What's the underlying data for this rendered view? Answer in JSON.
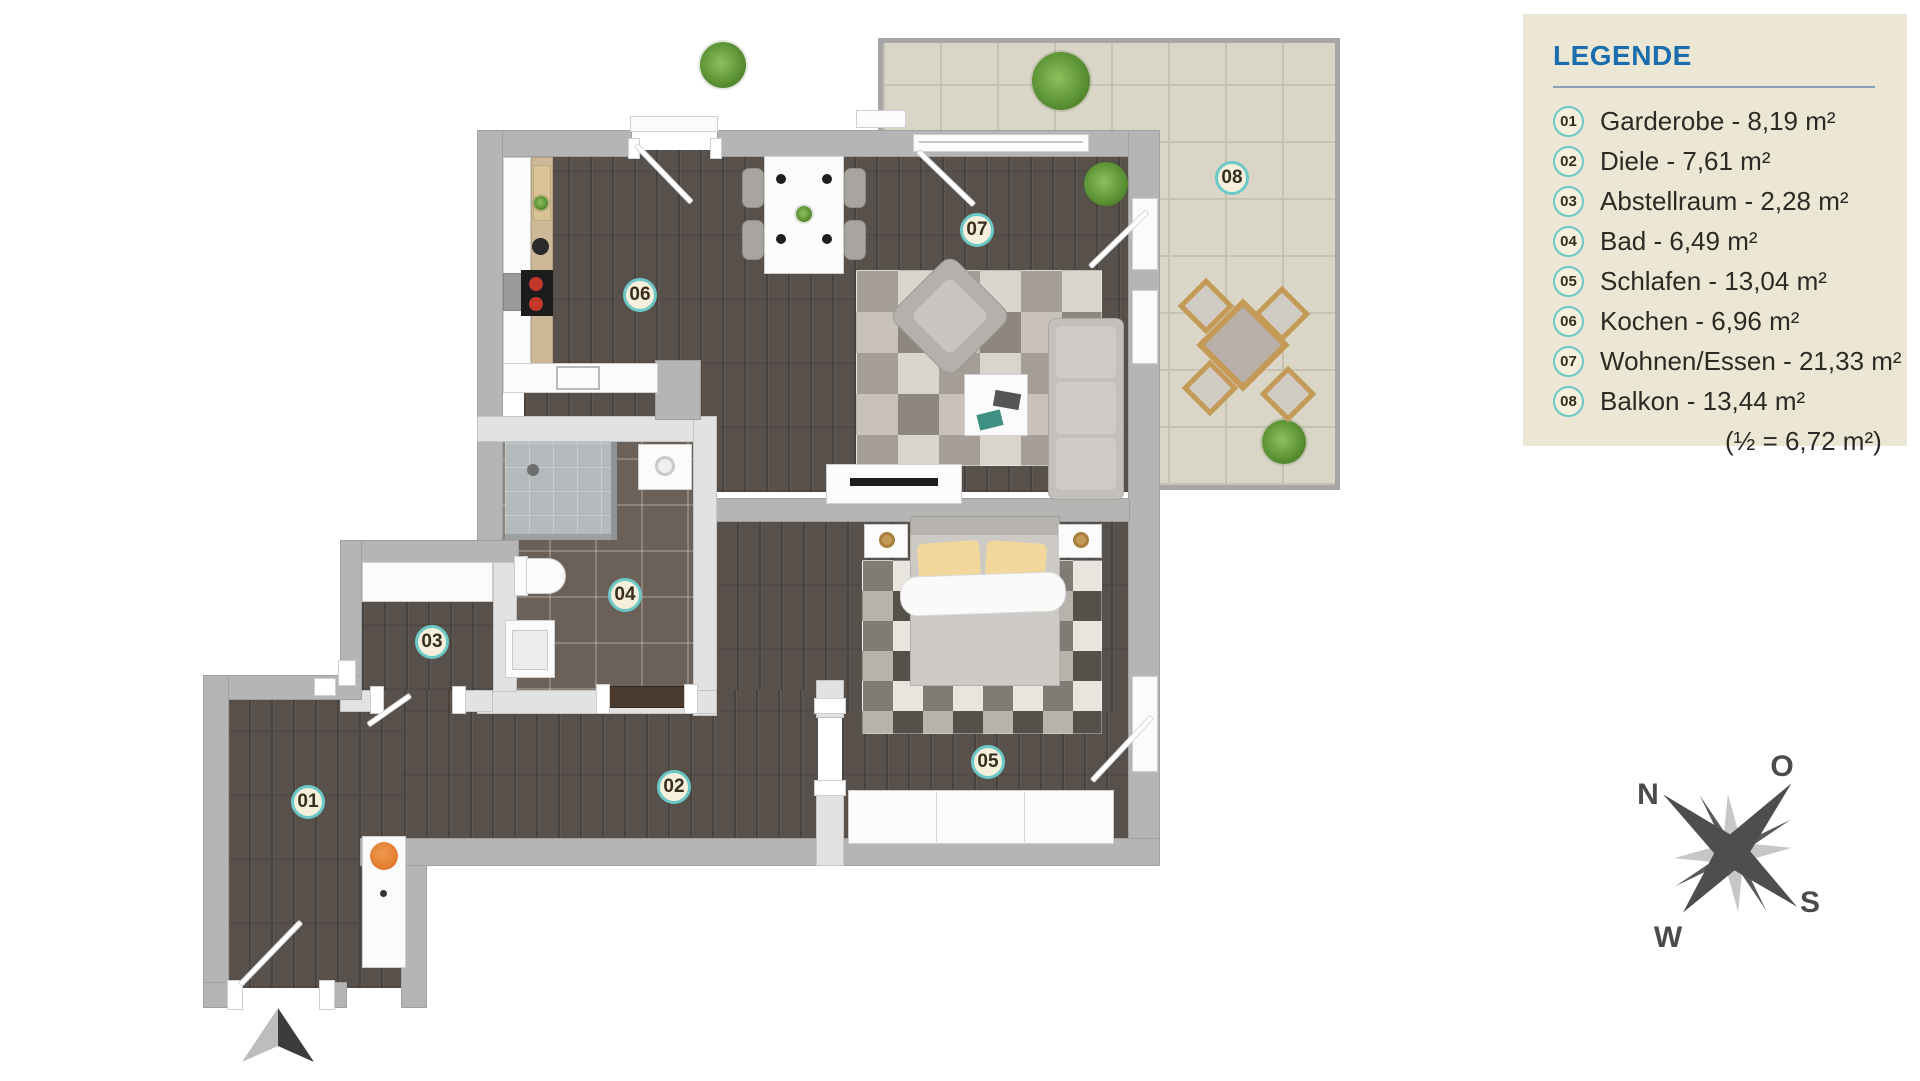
{
  "legend": {
    "title": "LEGENDE",
    "items": [
      {
        "number": "01",
        "label": "Garderobe - 8,19 m²"
      },
      {
        "number": "02",
        "label": "Diele - 7,61 m²"
      },
      {
        "number": "03",
        "label": "Abstellraum - 2,28 m²"
      },
      {
        "number": "04",
        "label": "Bad - 6,49 m²"
      },
      {
        "number": "05",
        "label": "Schlafen - 13,04 m²"
      },
      {
        "number": "06",
        "label": "Kochen - 6,96 m²"
      },
      {
        "number": "07",
        "label": "Wohnen/Essen - 21,33 m²"
      },
      {
        "number": "08",
        "label": "Balkon - 13,44 m²"
      }
    ],
    "note": "(½ = 6,72 m²)"
  },
  "compass": {
    "north": "N",
    "east": "O",
    "south": "S",
    "west": "W"
  },
  "colors": {
    "badge_ring_teal": "#6cc8c6",
    "badge_fill": "#f6efdc",
    "legend_title_blue": "#1b6ead",
    "legend_bg": "#ece6d4",
    "wall_gray": "#b5b5b5",
    "wood_floor": "#57504b",
    "balcony_tile": "#d9d5c7"
  }
}
